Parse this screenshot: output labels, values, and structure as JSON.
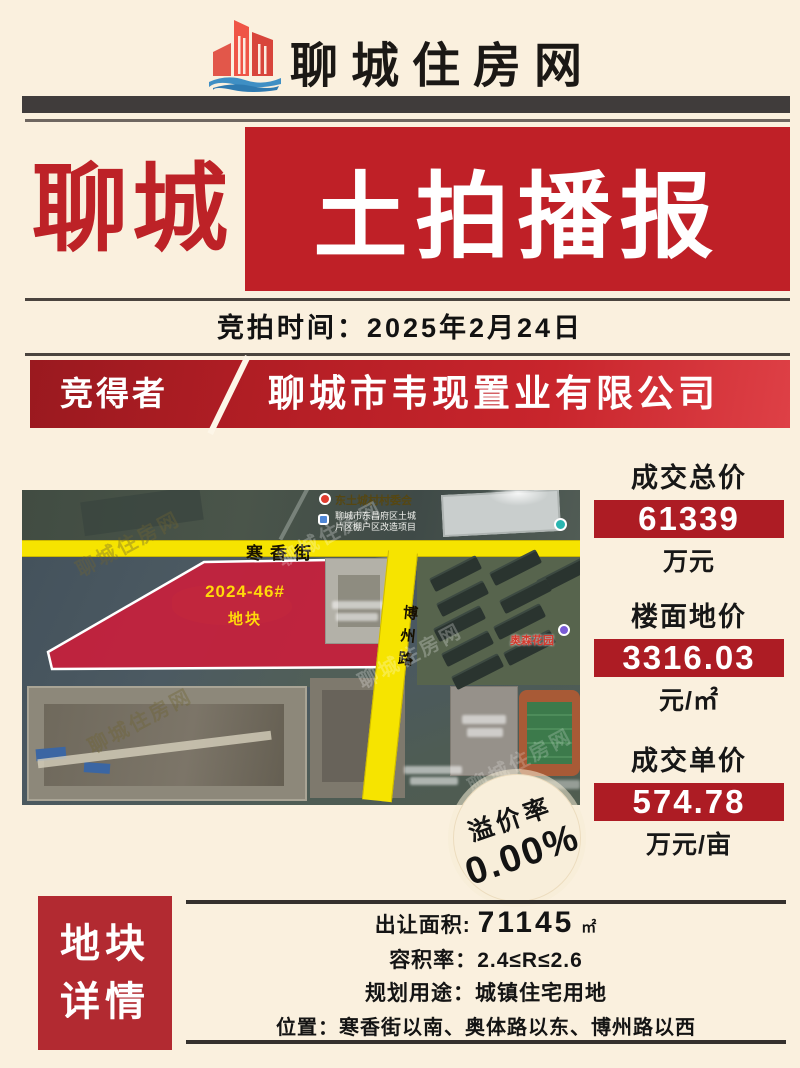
{
  "header": {
    "site_name": "聊城住房网",
    "logo": "buildings-with-wave"
  },
  "banner": {
    "city": "聊城",
    "title": "土拍播报"
  },
  "auction": {
    "date_line": "竞拍时间：2025年2月24日"
  },
  "winner": {
    "label": "竞得者",
    "company": "聊城市韦现置业有限公司"
  },
  "map": {
    "watermark": "聊城住房网",
    "roads": {
      "horizontal": "寒香街",
      "vertical": "博州路"
    },
    "plot": {
      "code": "2024-46#",
      "name": "地块"
    },
    "labels": {
      "village": "东土城村村委会",
      "project_line1": "聊城市东昌府区土城",
      "project_line2": "片区棚户区改造项目",
      "garden": "奥森花园"
    }
  },
  "stats": [
    {
      "label": "成交总价",
      "value": "61339",
      "unit": "万元"
    },
    {
      "label": "楼面地价",
      "value": "3316.03",
      "unit": "元/㎡"
    },
    {
      "label": "成交单价",
      "value": "574.78",
      "unit": "万元/亩"
    }
  ],
  "premium": {
    "label": "溢价率",
    "value": "0.00%"
  },
  "details": {
    "title_line1": "地块",
    "title_line2": "详情",
    "area_label": "出让面积:",
    "area_value": "71145",
    "area_unit": "㎡",
    "far_label": "容积率：",
    "far_value": "2.4≤R≤2.6",
    "use_label": "规划用途：",
    "use_value": "城镇住宅用地",
    "location_label": "位置：",
    "location_value": "寒香街以南、奥体路以东、博州路以西"
  },
  "colors": {
    "background": "#faf0de",
    "accent_red": "#bf2027",
    "stat_red": "#ad1c24",
    "road_yellow": "#f6e400",
    "plot_red": "#ce1c3a",
    "badge_cream": "#f8eeda"
  }
}
